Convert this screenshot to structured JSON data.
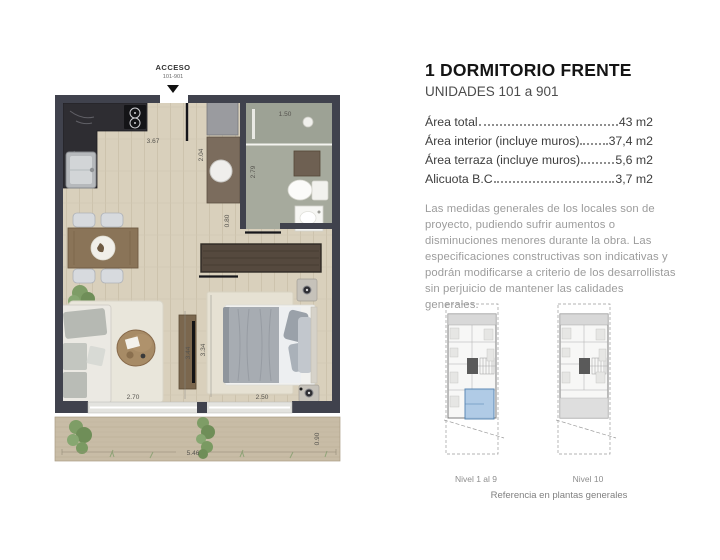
{
  "header": {
    "title": "1 DORMITORIO FRENTE",
    "subtitle": "UNIDADES 101 a 901"
  },
  "areas": {
    "rows": [
      {
        "label": "Área total",
        "value": "43 m2"
      },
      {
        "label": "Área interior (incluye muros)",
        "value": "37,4 m2"
      },
      {
        "label": "Área terraza (incluye muros)",
        "value": "5,6 m2"
      },
      {
        "label": "Alicuota B.C",
        "value": "3,7 m2"
      }
    ]
  },
  "disclaimer": "Las medidas generales de los locales son de proyecto, pudiendo sufrir aumentos o disminuciones menores durante la obra. Las especificaciones constructivas son indicativas y podrán modificarse a criterio de los desarrollistas sin perjuicio de mantener las calidades generales.",
  "floorplan": {
    "access_label": "ACCESO",
    "access_units": "101-901",
    "dims": {
      "kitchen_width": "3.67",
      "entry_depth": "2.04",
      "shower_width": "1.50",
      "bath_depth": "2.79",
      "hall_width": "0.80",
      "living_width": "2.70",
      "living_depth": "3.44",
      "bedroom_depth": "3.34",
      "bedroom_width": "2.50",
      "terrace_width": "5.46",
      "terrace_depth": "0.90"
    }
  },
  "reference": {
    "levels_left": "Nivel 1 al 9",
    "levels_right": "Nivel 10",
    "caption": "Referencia en plantas generales",
    "highlight_color": "#a9c7e5"
  },
  "colors": {
    "wall": "#40424d",
    "wood_floor": "#d9d0bc",
    "bath_floor": "#a6aa9d",
    "terrace": "#c8bca6",
    "kitchen_counter": "#2e2d32",
    "highlight_blue": "#a9c7e5"
  }
}
